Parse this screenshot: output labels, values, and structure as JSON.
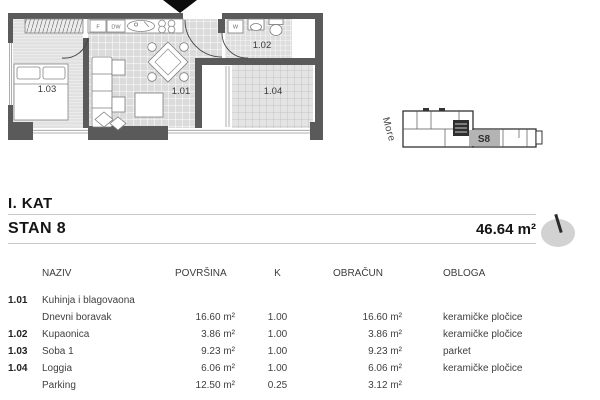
{
  "header": {
    "floor_label": "I. KAT",
    "unit_label": "STAN 8",
    "total_area": "46.64 m²"
  },
  "floorplan": {
    "room_ids": {
      "living": "1.01",
      "bathroom": "1.02",
      "bedroom": "1.03",
      "loggia": "1.04"
    },
    "appliances": {
      "fridge": "F",
      "dishwasher": "DW",
      "washer": "W"
    }
  },
  "site": {
    "sea_label": "More",
    "unit_label": "S8"
  },
  "table": {
    "headers": [
      "NAZIV",
      "POVRŠINA",
      "K",
      "OBRAČUN",
      "OBLOGA"
    ],
    "rows": [
      {
        "code": "1.01",
        "name": "Kuhinja i blagovaona",
        "area": "",
        "k": "",
        "calc": "",
        "finish": ""
      },
      {
        "code": "",
        "name": "Dnevni boravak",
        "area": "16.60 m²",
        "k": "1.00",
        "calc": "16.60 m²",
        "finish": "keramičke pločice"
      },
      {
        "code": "1.02",
        "name": "Kupaonica",
        "area": "3.86 m²",
        "k": "1.00",
        "calc": "3.86 m²",
        "finish": "keramičke pločice"
      },
      {
        "code": "1.03",
        "name": "Soba 1",
        "area": "9.23 m²",
        "k": "1.00",
        "calc": "9.23 m²",
        "finish": "parket"
      },
      {
        "code": "1.04",
        "name": "Loggia",
        "area": "6.06 m²",
        "k": "1.00",
        "calc": "6.06 m²",
        "finish": "keramičke pločice"
      },
      {
        "code": "",
        "name": "Parking",
        "area": "12.50 m²",
        "k": "0.25",
        "calc": "3.12 m²",
        "finish": ""
      }
    ]
  }
}
